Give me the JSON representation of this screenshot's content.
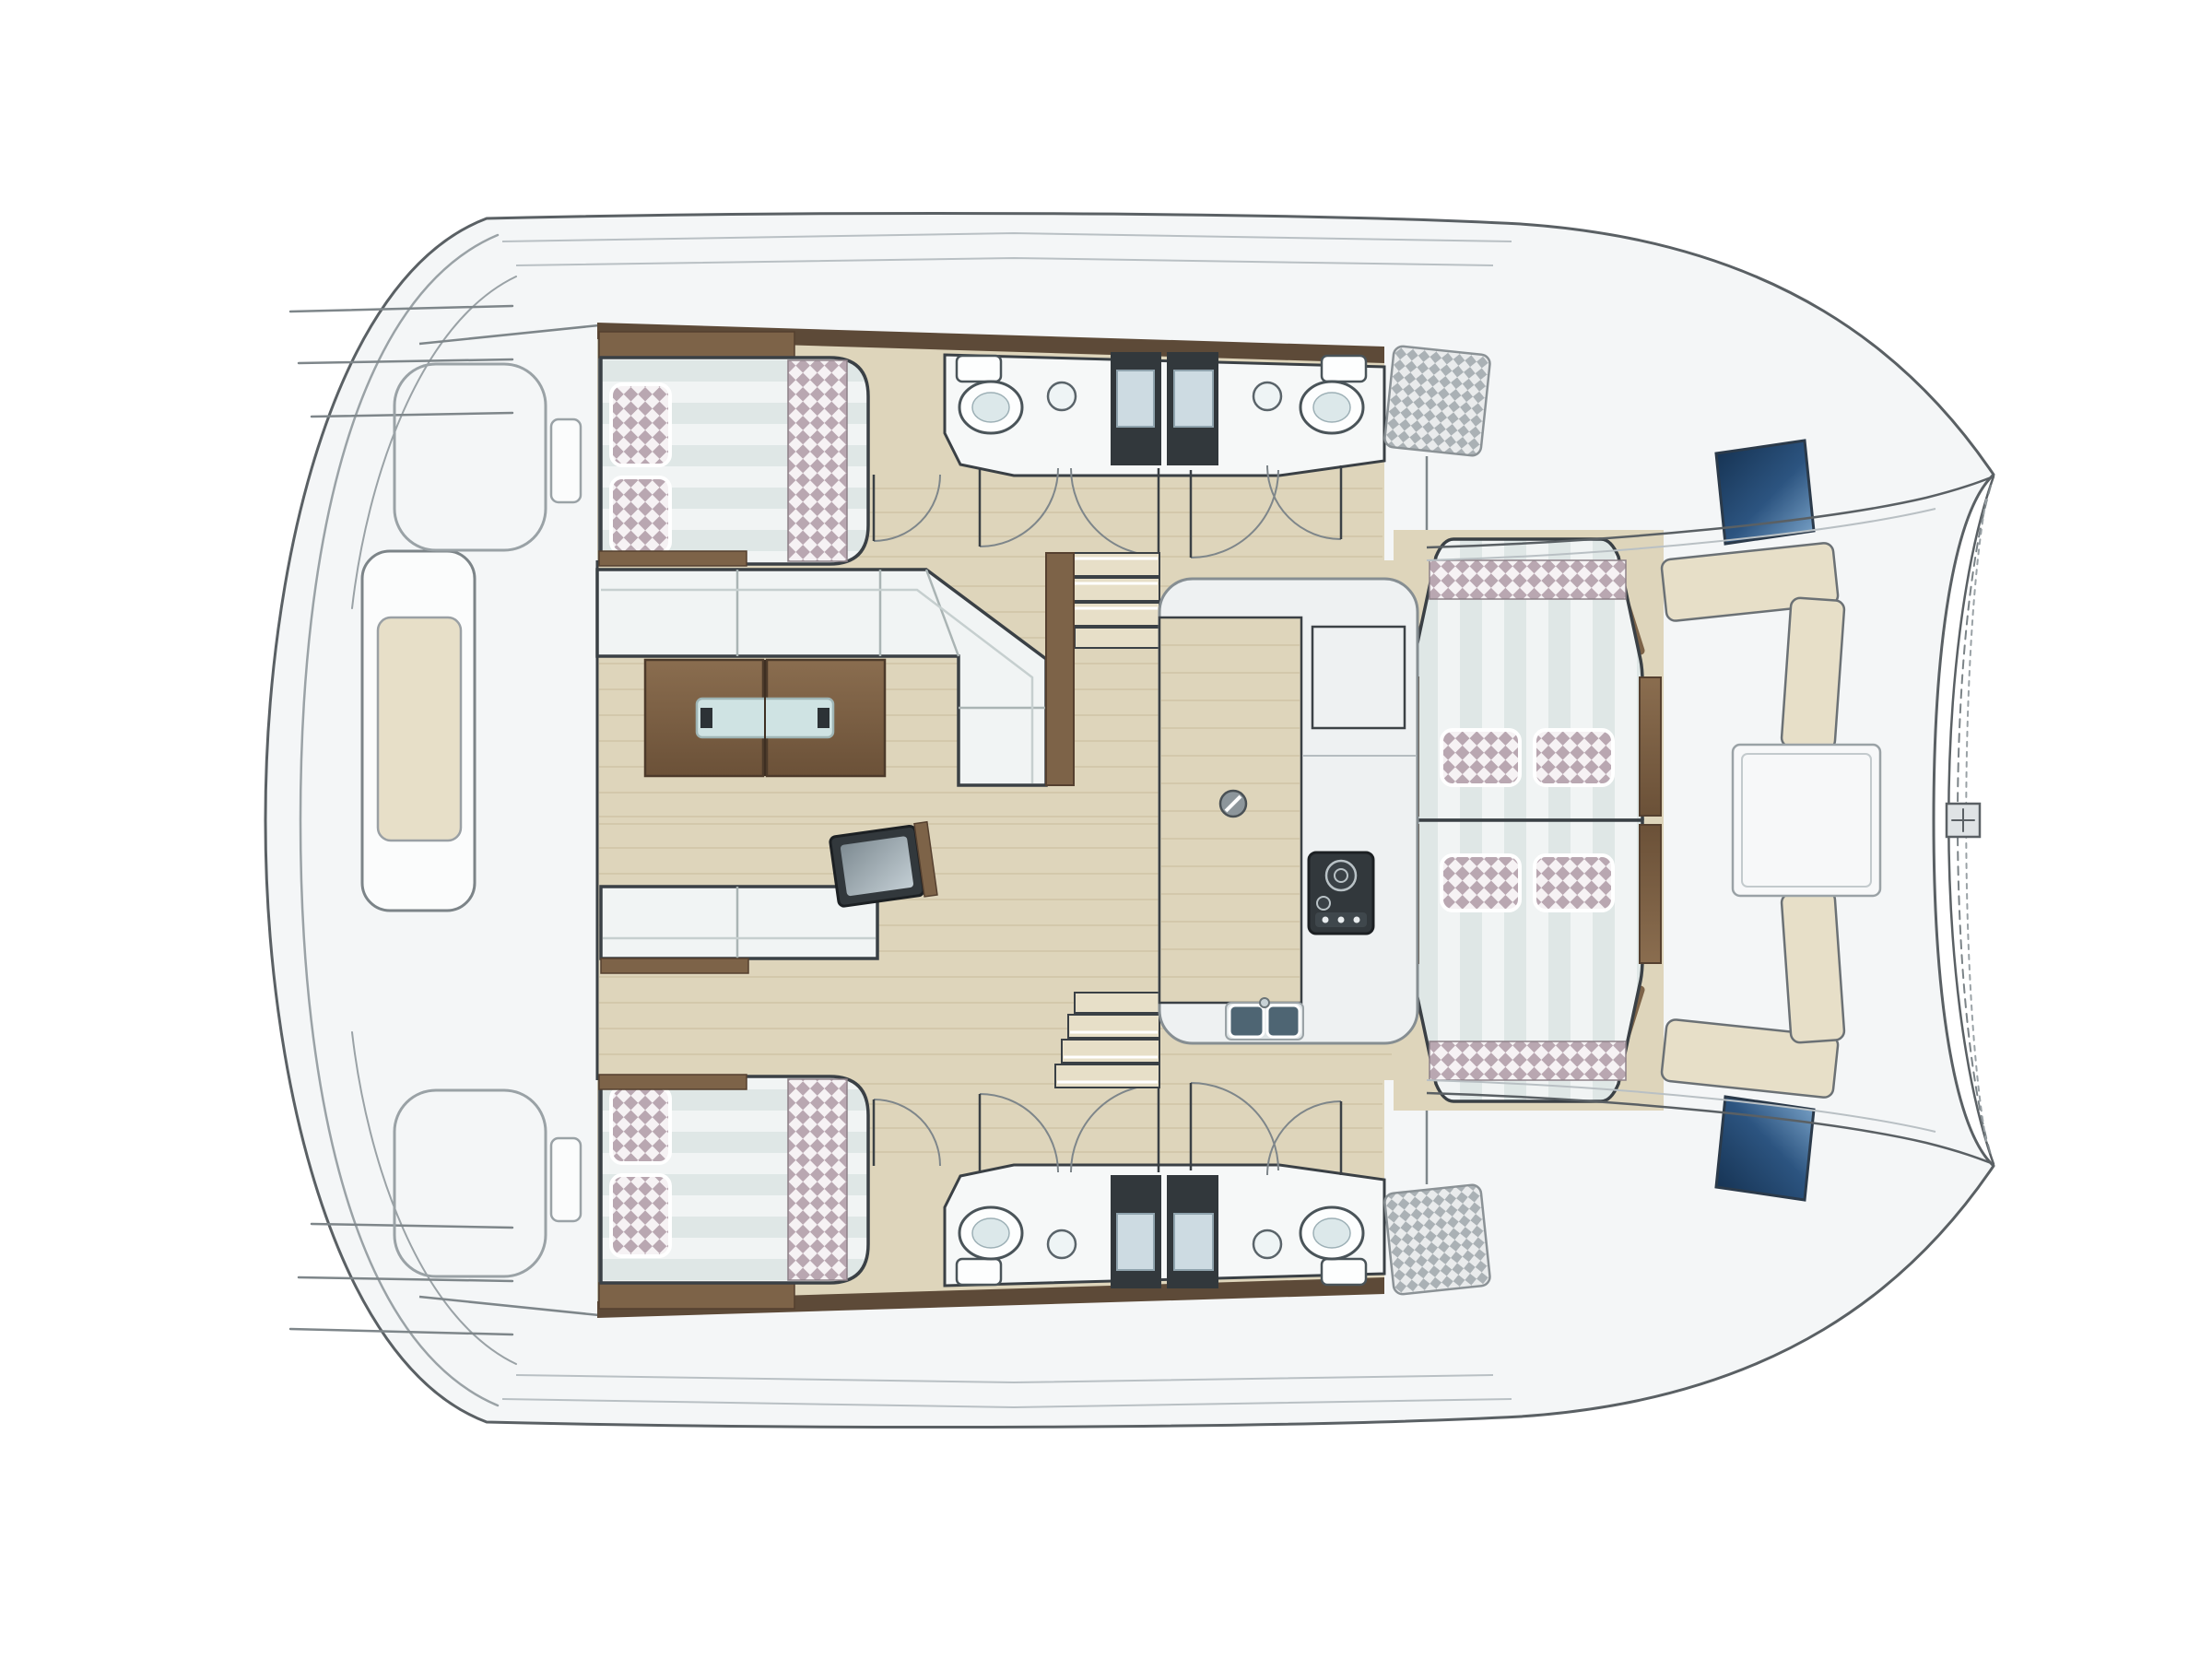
{
  "meta": {
    "title": "Catamaran interior floor plan (top view)",
    "drawing_type": "yacht-deck-and-accommodation-plan",
    "orientation": {
      "bow": "right",
      "stern": "left",
      "symmetry_axis": "horizontal-center"
    }
  },
  "palette": {
    "deck": "#f4f6f7",
    "edge": "#5a6064",
    "edge_light": "#9aa2a6",
    "line": "#7e868a",
    "wood_floor": "#ded5bb",
    "plank": "#cfc4a6",
    "wood": "#7d6348",
    "wood_dark": "#55402f",
    "trim": "#5d4a38",
    "uph": "#f1f4f4",
    "uph_stripe": "#dfe7e6",
    "uph_edge": "#3a4045",
    "pillow": "#b9a7b1",
    "pillow_bg": "#f6f2f4",
    "hatchgray": "#aab1b5",
    "hatchgray_bg": "#e9ebec",
    "blue_dark": "#14304f",
    "blue_mid": "#2c5480",
    "blue_light": "#7fa8cd",
    "appliance": "#32383c",
    "appliance_dark": "#1c2023",
    "counter": "#eef1f2",
    "counter_edge": "#868e92",
    "sink": "#4e6573",
    "glass": "#cfe3e3",
    "step": "#e7dfc8",
    "white": "#ffffff"
  },
  "inventory": {
    "double_berth_cabins": 2,
    "berth_pillows_per_cabin": 2,
    "head_compartments": 4,
    "toilets": 4,
    "wash_basins": 4,
    "shower_trays": 4,
    "companionway_stairs": 2,
    "salon_sofas": 2,
    "coffee_table_halves": 2,
    "tv_console": 1,
    "galley": {
      "stove": 1,
      "sink_basins": 2,
      "fridge_locker": 1,
      "mast_post": 1
    },
    "dinette_lounge_pillows": 4,
    "forward_cockpit_benches": 2,
    "blue_deck_hatches": 2,
    "hatched_storage_lockers": 2,
    "anchor_locker": 1,
    "helm_bench": 1,
    "transom_step_lines_per_quarter": 3,
    "door_swing_arcs": 10
  }
}
